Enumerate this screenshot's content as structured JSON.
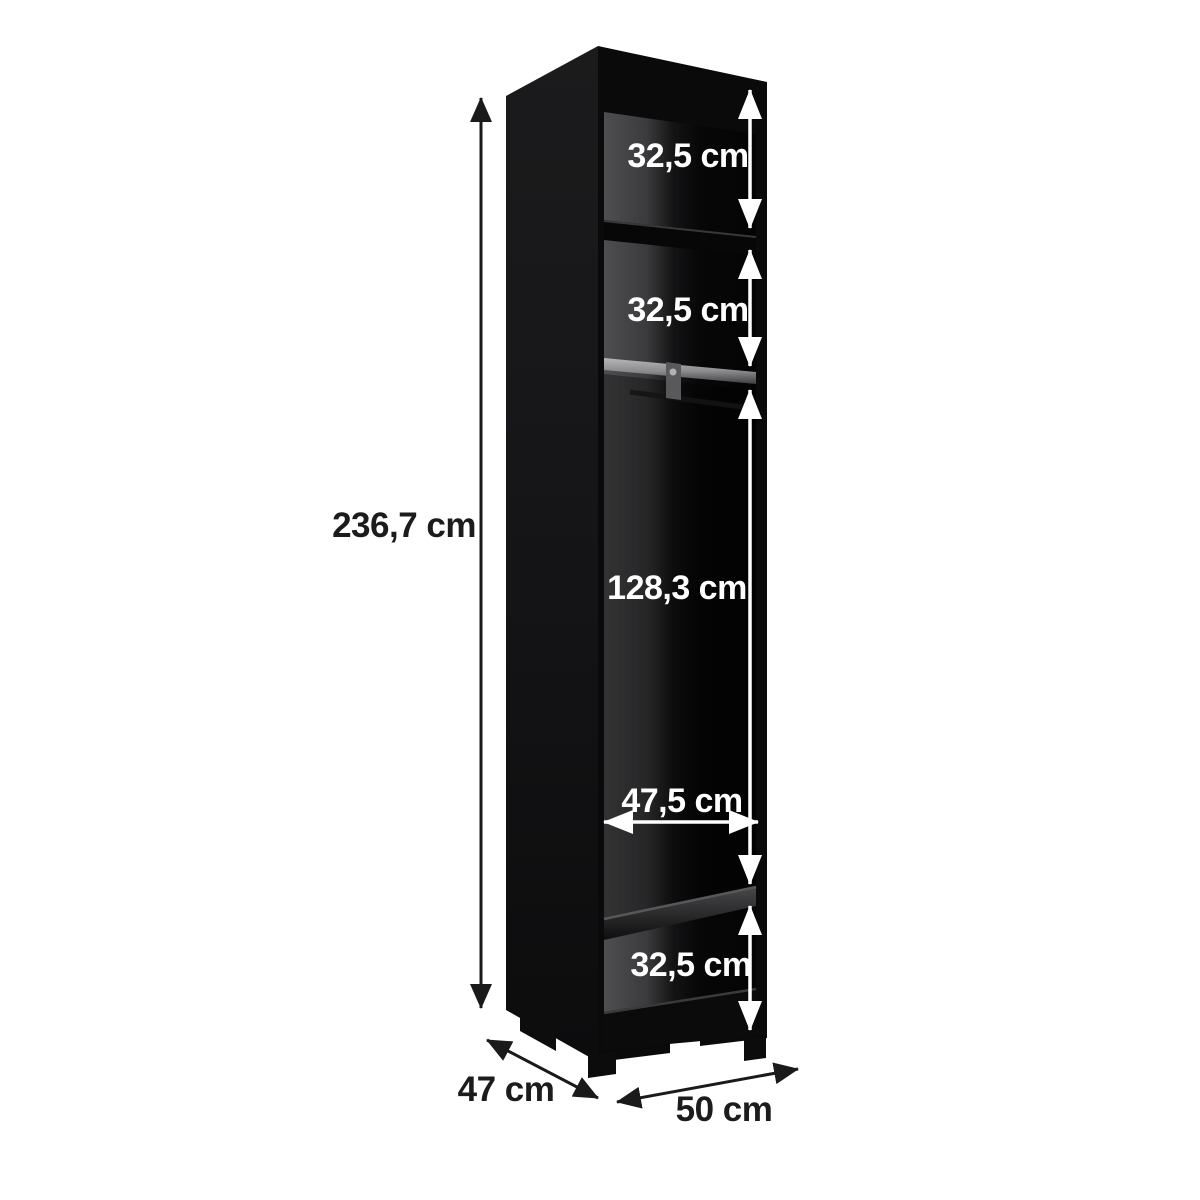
{
  "labels": {
    "total_height": "236,7 cm",
    "top_section": "32,5 cm",
    "middle_section": "32,5 cm",
    "hanging_section": "128,3 cm",
    "interior_width": "47,5 cm",
    "bottom_section": "32,5 cm",
    "depth": "47 cm",
    "width": "50 cm"
  },
  "colors": {
    "background": "#ffffff",
    "cabinet_body": "#0b0b0c",
    "back_panel_highlight": "#4e4e50",
    "rail_metal": "#9a9a9c",
    "dimension_line_light": "#ffffff",
    "dimension_line_dark": "#1a1a1a"
  }
}
